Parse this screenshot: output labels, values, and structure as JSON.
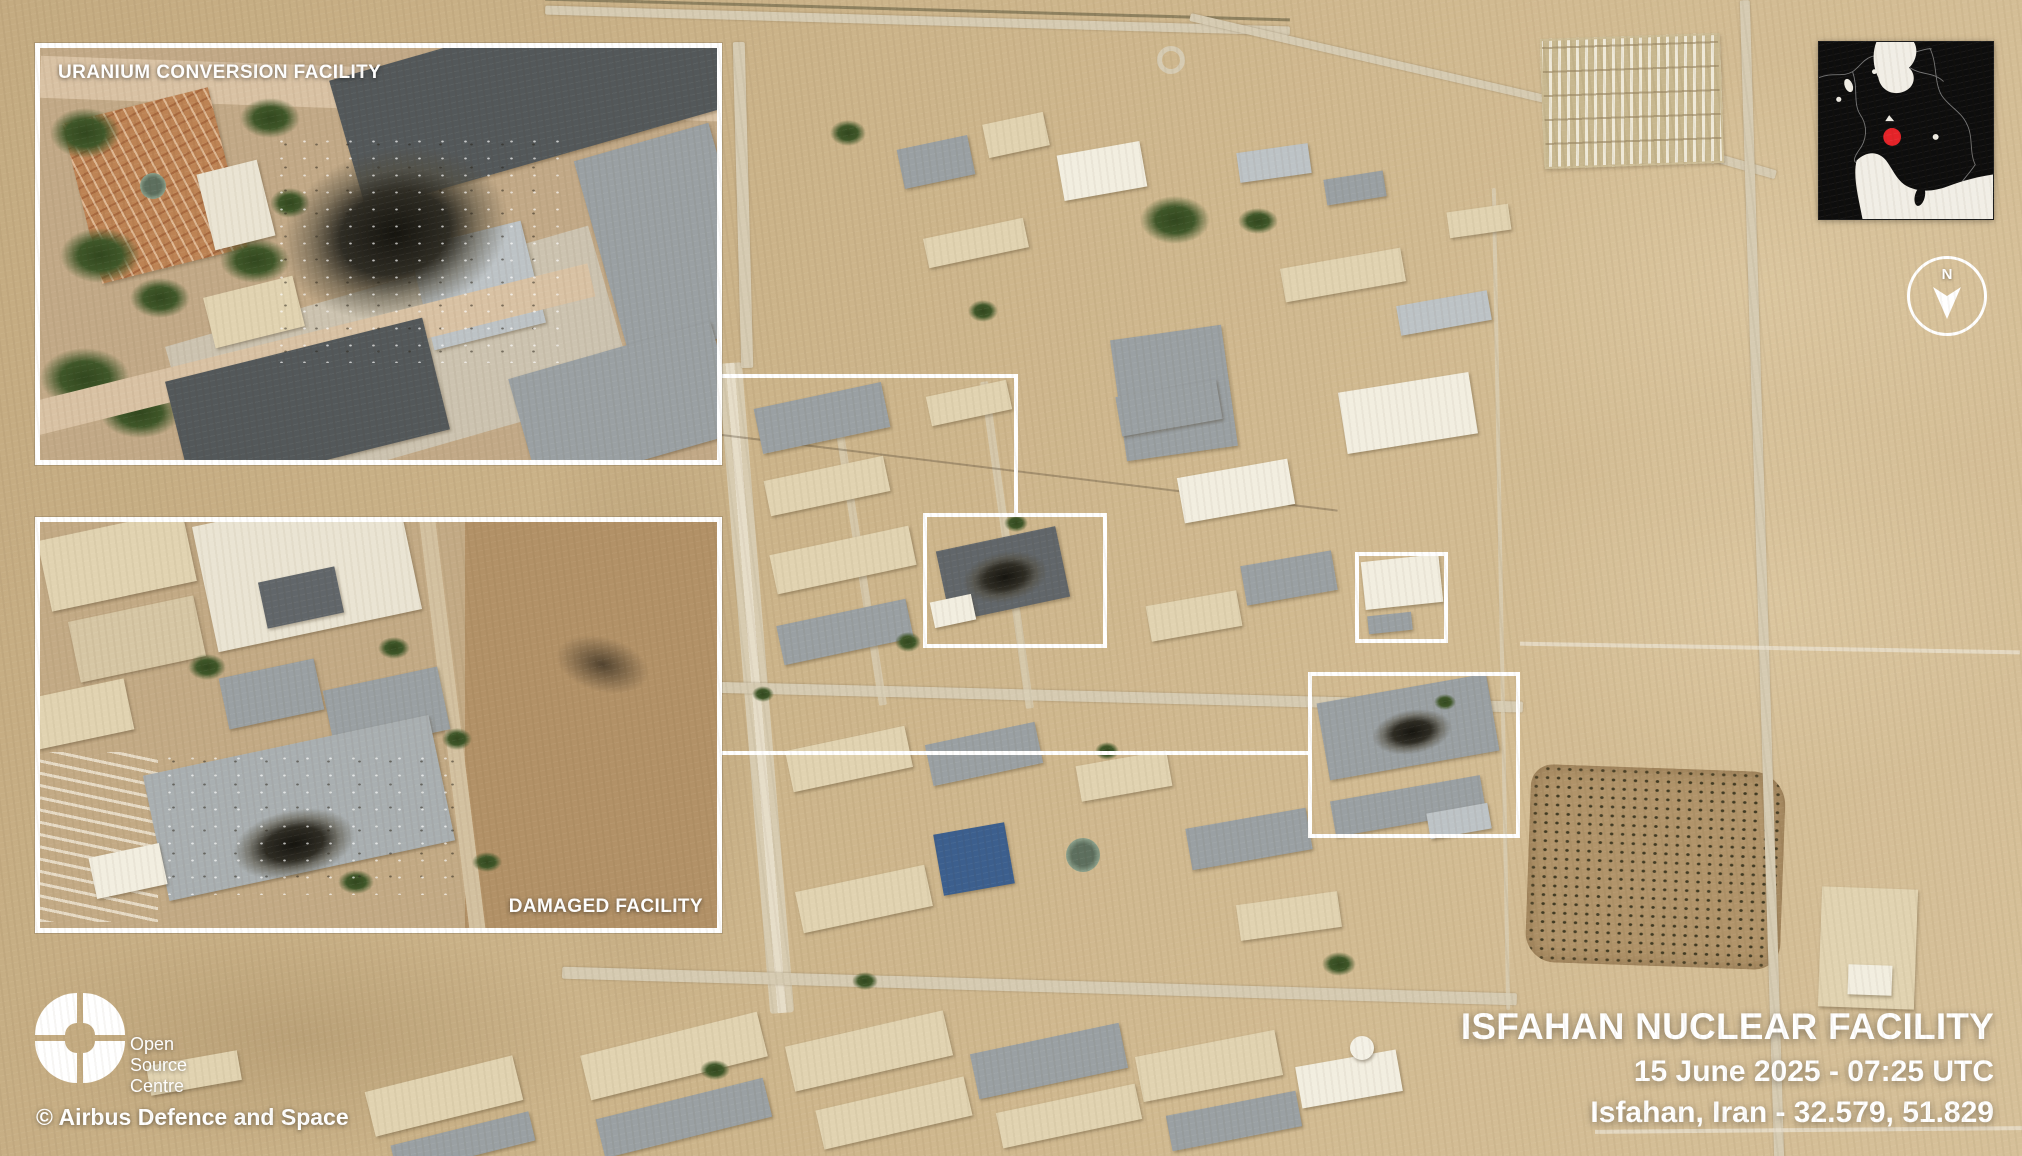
{
  "insets": {
    "uranium_conversion": {
      "label": "URANIUM CONVERSION FACILITY"
    },
    "damaged": {
      "label": "DAMAGED FACILITY"
    }
  },
  "title_block": {
    "facility_name": "ISFAHAN NUCLEAR FACILITY",
    "capture_datetime": "15 June 2025 - 07:25 UTC",
    "location_coords": "Isfahan, Iran - 32.579, 51.829"
  },
  "branding": {
    "logo_words": {
      "w1": "Open",
      "w2": "Source",
      "w3": "Centre"
    },
    "copyright": "© Airbus Defence and Space"
  },
  "compass": {
    "north_label": "N"
  },
  "locator_map": {
    "marker_color": "#e62329",
    "land_color": "#0d0d0d",
    "water_color": "#f1eee6",
    "border_line_color": "#9a9a9a"
  },
  "annotation_style": {
    "highlight_color": "#ffffff"
  }
}
